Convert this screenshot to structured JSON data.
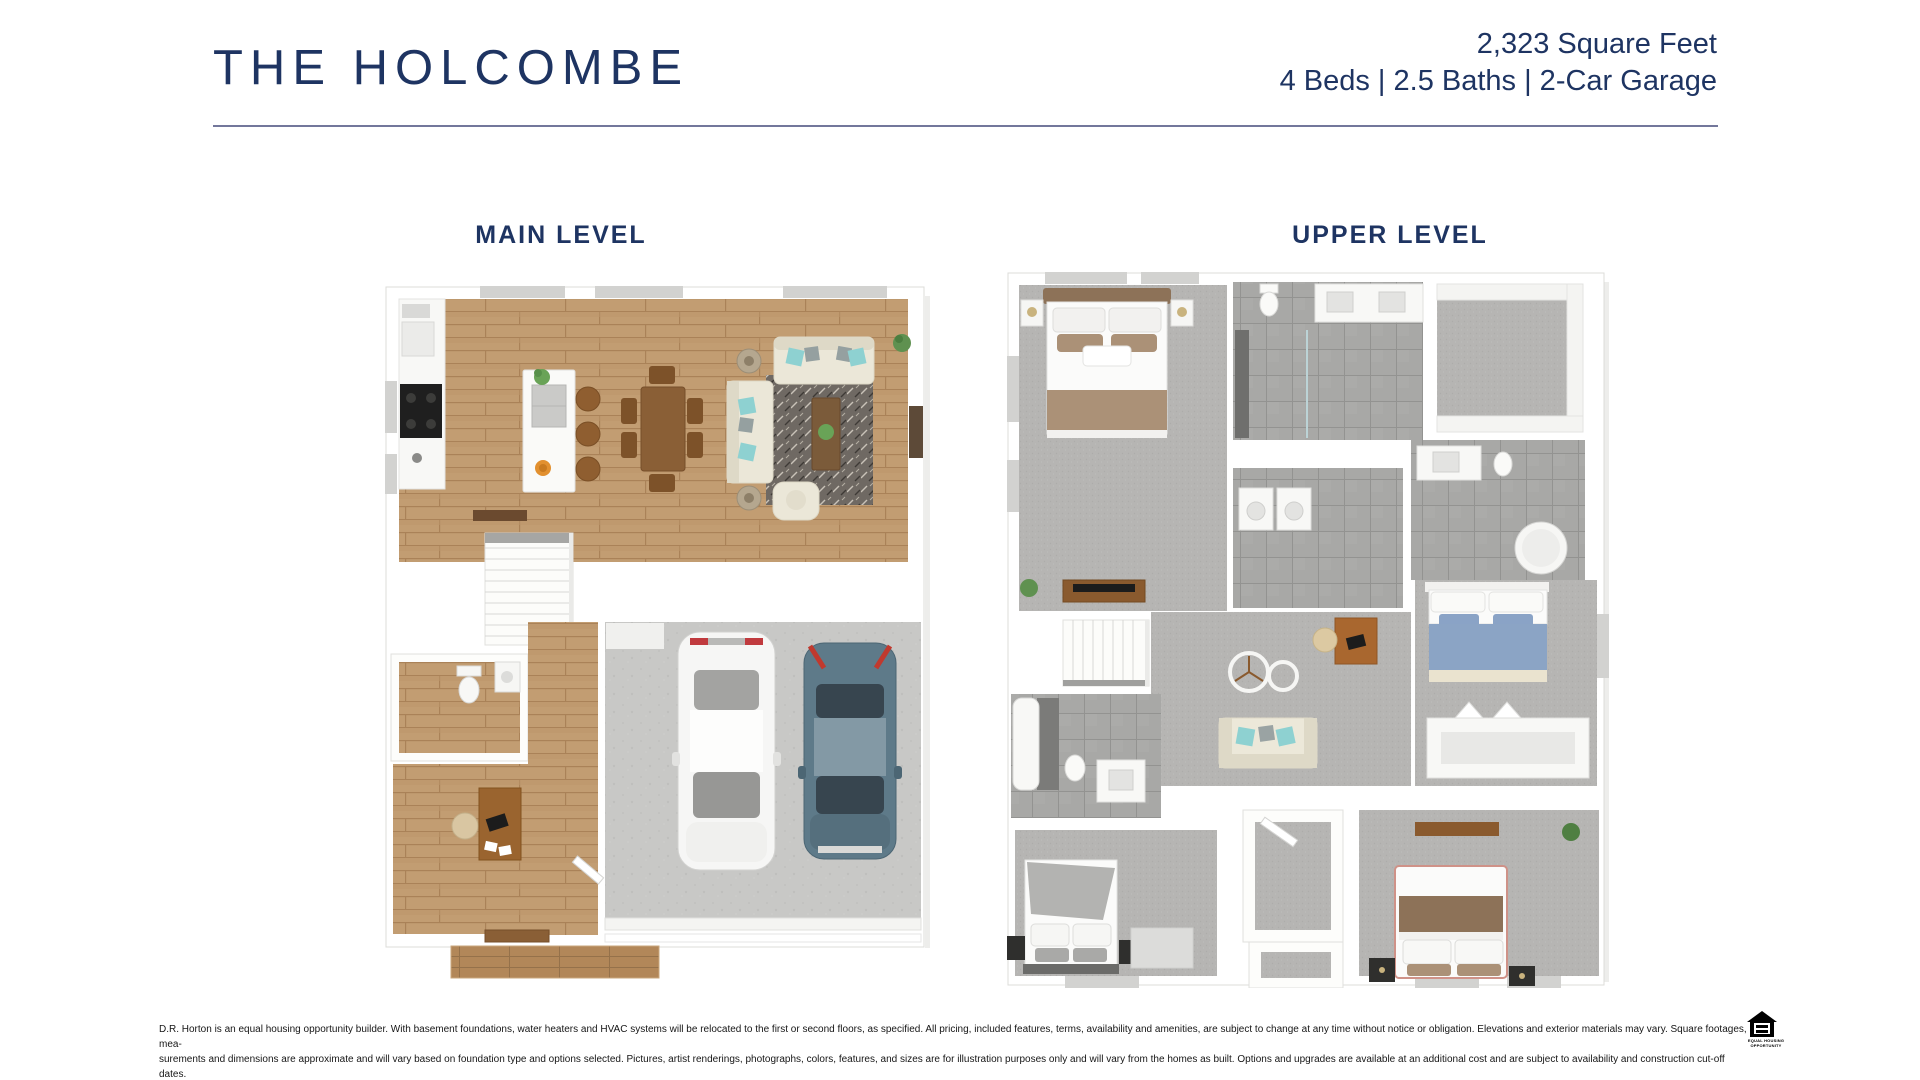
{
  "header": {
    "title": "THE HOLCOMBE",
    "sqft": "2,323 Square Feet",
    "specs": "4 Beds | 2.5 Baths | 2-Car Garage"
  },
  "plans": {
    "main": {
      "label": "MAIN LEVEL"
    },
    "upper": {
      "label": "UPPER LEVEL"
    }
  },
  "footer": {
    "disclaimer_line1": "D.R. Horton is an equal housing opportunity builder. With basement foundations, water heaters and HVAC systems will be relocated to the first or second floors, as specified. All pricing, included features, terms, availability and amenities, are subject to change at any time without notice or obligation. Elevations and exterior materials may vary. Square footages, mea-",
    "disclaimer_line2": "surements and dimensions are approximate and will vary based on foundation type and options selected. Pictures, artist renderings, photographs, colors, features, and sizes are for illustration purposes only and will vary from the homes as built. Options and upgrades are available at an additional cost and are subject to availability and construction cut-off dates.",
    "equal_housing_line1": "EQUAL HOUSING",
    "equal_housing_line2": "OPPORTUNITY"
  },
  "colors": {
    "accent_navy": "#1e3462",
    "divider": "#73779b",
    "wood_floor": "#c29d72",
    "carpet": "#b6b5b3",
    "tile": "#a8a8a6",
    "concrete": "#c8c8c6"
  }
}
